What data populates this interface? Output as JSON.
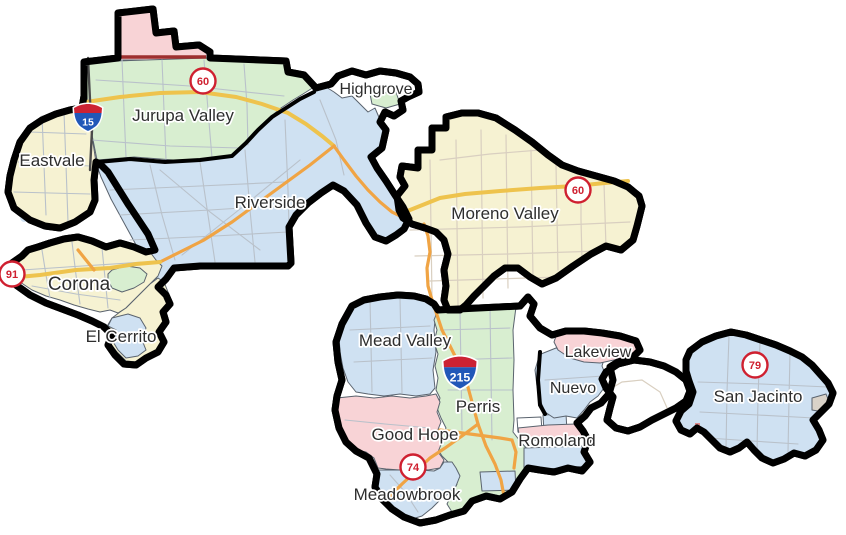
{
  "map": {
    "kind": "city-boundaries-map",
    "area": "district map with city areas and highway shields"
  },
  "palette": {
    "outline": "#000000",
    "yellow": "#f6f2d2",
    "green": "#d8eed0",
    "blue": "#cfe1f2",
    "pink": "#f8d3d6",
    "white": "#ffffff",
    "street_gray": "#b9c1ca",
    "road_beige": "#d9cfc0",
    "freeway_yellow": "#eec34d",
    "freeway_orange": "#f0a444",
    "shield_red": "#cf2030",
    "interstate_blue": "#2157b8",
    "interstate_red": "#cc2233",
    "dark_red_road": "#9e2f2f"
  },
  "cities": [
    {
      "name": "Eastvale",
      "fill": "yellow"
    },
    {
      "name": "Jurupa Valley",
      "fill": "green"
    },
    {
      "name": "Highgrove",
      "fill": "green"
    },
    {
      "name": "Riverside",
      "fill": "blue"
    },
    {
      "name": "Moreno Valley",
      "fill": "yellow"
    },
    {
      "name": "Corona",
      "fill": "yellow"
    },
    {
      "name": "El Cerrito",
      "fill": "yellow"
    },
    {
      "name": "Mead Valley",
      "fill": "blue"
    },
    {
      "name": "Perris",
      "fill": "green"
    },
    {
      "name": "Good Hope",
      "fill": "pink"
    },
    {
      "name": "Meadowbrook",
      "fill": "blue"
    },
    {
      "name": "Romoland",
      "fill": "pink"
    },
    {
      "name": "Nuevo",
      "fill": "blue"
    },
    {
      "name": "Lakeview",
      "fill": "pink"
    },
    {
      "name": "San Jacinto",
      "fill": "blue"
    }
  ],
  "shields": [
    {
      "type": "interstate",
      "label": "15"
    },
    {
      "type": "interstate",
      "label": "215"
    },
    {
      "type": "circle",
      "label": "60"
    },
    {
      "type": "circle",
      "label": "60"
    },
    {
      "type": "circle",
      "label": "91"
    },
    {
      "type": "circle",
      "label": "74"
    },
    {
      "type": "circle",
      "label": "79"
    }
  ]
}
